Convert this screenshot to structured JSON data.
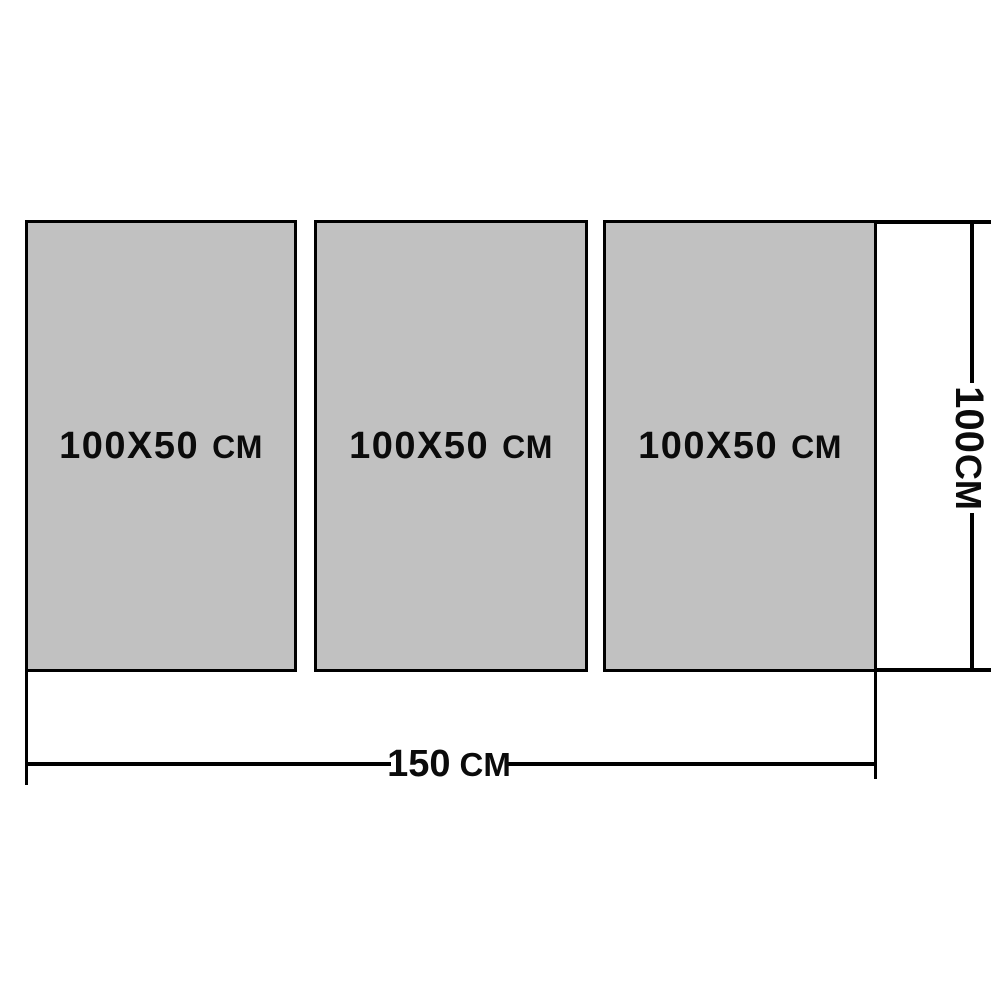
{
  "diagram": {
    "panels": [
      {
        "size": "100X50",
        "unit": "CM"
      },
      {
        "size": "100X50",
        "unit": "CM"
      },
      {
        "size": "100X50",
        "unit": "CM"
      }
    ],
    "width_dimension": {
      "value": "150",
      "unit": "CM"
    },
    "height_dimension": {
      "value": "100",
      "unit": "CM"
    },
    "colors": {
      "panel_fill": "#c1c1c1",
      "line": "#000000",
      "text": "#0b0b0b",
      "background": "#ffffff"
    }
  }
}
